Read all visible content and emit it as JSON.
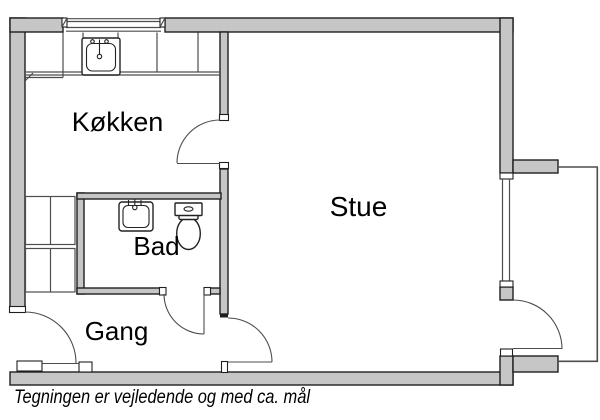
{
  "drawing": {
    "kind": "apartment-floorplan",
    "rooms": {
      "kitchen": {
        "label": "Køkken"
      },
      "living_room": {
        "label": "Stue"
      },
      "bathroom": {
        "label": "Bad"
      },
      "hallway": {
        "label": "Gang"
      }
    },
    "caption": {
      "text": "Tegningen er vejledende og med ca. mål"
    },
    "fixtures": {
      "kitchen_sink": "kitchen-sink",
      "kitchen_counter": "kitchen-counter",
      "kitchen_window": "kitchen-window",
      "bathroom_sink": "bathroom-sink",
      "toilet": "toilet",
      "wardrobe": "wardrobe-cabinets",
      "living_room_window": "living-room-window",
      "balcony": "balcony-railing",
      "doors": [
        "entry-door",
        "kitchen-door",
        "bathroom-door",
        "living-room-door",
        "balcony-door"
      ]
    }
  },
  "colors": {
    "wall-fill": "#c6c6c6",
    "wall-stroke": "#1f1f1f",
    "line": "#4d4d4d",
    "line-dark": "#222222",
    "text": "#000000",
    "bg": "#ffffff"
  }
}
